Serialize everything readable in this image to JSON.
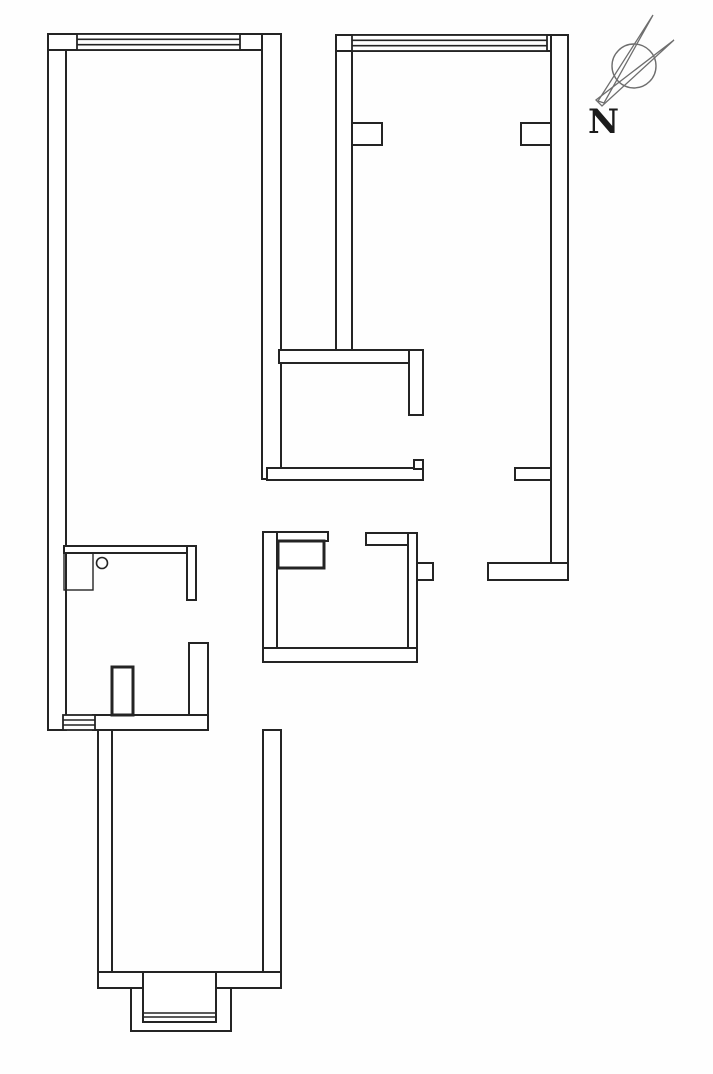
{
  "floorplan": {
    "canvas": {
      "width": 713,
      "height": 1074,
      "line_color": "#242424",
      "wall_fill": "#ffffff",
      "background": "#fefefe"
    },
    "walls": [
      {
        "name": "left-exterior-wall",
        "x": 48,
        "y": 34,
        "w": 18,
        "h": 696
      },
      {
        "name": "top-left-room-top-wall",
        "x": 48,
        "y": 34,
        "w": 233,
        "h": 16
      },
      {
        "name": "left-room-right-wall",
        "x": 262,
        "y": 34,
        "w": 19,
        "h": 445
      },
      {
        "name": "right-room-left-wall",
        "x": 336,
        "y": 35,
        "w": 16,
        "h": 315
      },
      {
        "name": "top-right-room-top-wall",
        "x": 336,
        "y": 35,
        "w": 232,
        "h": 16
      },
      {
        "name": "right-exterior-wall",
        "x": 551,
        "y": 35,
        "w": 17,
        "h": 545
      },
      {
        "name": "right-room-bottom-wall",
        "x": 488,
        "y": 563,
        "w": 80,
        "h": 17
      },
      {
        "name": "right-room-left-pier",
        "x": 352,
        "y": 123,
        "w": 30,
        "h": 22
      },
      {
        "name": "right-room-right-pier",
        "x": 521,
        "y": 123,
        "w": 30,
        "h": 22
      },
      {
        "name": "right-wall-stub",
        "x": 515,
        "y": 468,
        "w": 36,
        "h": 12
      },
      {
        "name": "middle-upper-horizontal-wall",
        "x": 279,
        "y": 350,
        "w": 144,
        "h": 13
      },
      {
        "name": "middle-vertical-wall",
        "x": 409,
        "y": 350,
        "w": 14,
        "h": 65
      },
      {
        "name": "middle-lower-horizontal-wall",
        "x": 267,
        "y": 468,
        "w": 156,
        "h": 12
      },
      {
        "name": "door-jamb-hook",
        "x": 414,
        "y": 460,
        "w": 9,
        "h": 9
      },
      {
        "name": "kitchen-top-wall-left",
        "x": 263,
        "y": 532,
        "w": 65,
        "h": 9
      },
      {
        "name": "kitchen-top-wall-right",
        "x": 366,
        "y": 533,
        "w": 51,
        "h": 12
      },
      {
        "name": "kitchen-left-wall",
        "x": 263,
        "y": 532,
        "w": 14,
        "h": 130
      },
      {
        "name": "kitchen-right-wall",
        "x": 408,
        "y": 533,
        "w": 9,
        "h": 129
      },
      {
        "name": "kitchen-bottom-wall",
        "x": 263,
        "y": 648,
        "w": 154,
        "h": 14
      },
      {
        "name": "kitchen-right-pier",
        "x": 417,
        "y": 563,
        "w": 16,
        "h": 17
      },
      {
        "name": "bathroom-top-wall",
        "x": 64,
        "y": 546,
        "w": 132,
        "h": 7
      },
      {
        "name": "bathroom-right-wall-upper",
        "x": 187,
        "y": 546,
        "w": 9,
        "h": 54
      },
      {
        "name": "bathroom-right-wall-lower",
        "x": 189,
        "y": 643,
        "w": 19,
        "h": 87
      },
      {
        "name": "bathroom-bottom-wall",
        "x": 93,
        "y": 715,
        "w": 115,
        "h": 15
      },
      {
        "name": "balcony-left-wall",
        "x": 98,
        "y": 730,
        "w": 14,
        "h": 258
      },
      {
        "name": "balcony-right-wall",
        "x": 263,
        "y": 730,
        "w": 18,
        "h": 258
      },
      {
        "name": "balcony-bottom-wall-left",
        "x": 98,
        "y": 972,
        "w": 45,
        "h": 16
      },
      {
        "name": "balcony-bottom-wall-right",
        "x": 216,
        "y": 972,
        "w": 65,
        "h": 16
      },
      {
        "name": "bay-window-outer",
        "x": 131,
        "y": 988,
        "w": 100,
        "h": 43
      },
      {
        "name": "bay-window-inner",
        "x": 143,
        "y": 972,
        "w": 73,
        "h": 50
      }
    ],
    "windows": [
      {
        "name": "window-top-left-room",
        "x": 77,
        "y": 34,
        "w": 163,
        "h": 16,
        "inner_lines": 2
      },
      {
        "name": "window-top-right-room",
        "x": 352,
        "y": 35,
        "w": 195,
        "h": 16,
        "inner_lines": 2
      },
      {
        "name": "window-bottom-left",
        "x": 63,
        "y": 715,
        "w": 32,
        "h": 15,
        "inner_lines": 2
      }
    ],
    "fixtures": [
      {
        "name": "kitchen-counter-fixture",
        "x": 278,
        "y": 541,
        "w": 46,
        "h": 27
      },
      {
        "name": "entry-door-leaf",
        "x": 112,
        "y": 667,
        "w": 21,
        "h": 48
      }
    ],
    "furniture": [
      {
        "name": "bathroom-cabinet",
        "x": 64,
        "y": 553,
        "w": 29,
        "h": 37
      }
    ],
    "circles": [
      {
        "name": "bathroom-drain-circle",
        "cx": 102,
        "cy": 563,
        "r": 5.5
      }
    ],
    "lines": [
      {
        "name": "bay-window-glazing-line",
        "x1": 143,
        "y1": 1013,
        "x2": 216,
        "y2": 1013
      },
      {
        "name": "bay-window-glazing-line",
        "x1": 143,
        "y1": 1017,
        "x2": 216,
        "y2": 1017
      }
    ],
    "compass": {
      "label": "N",
      "color": "#6e6e6e",
      "label_color": "#1b1b1b",
      "cx": 634,
      "cy": 66,
      "r": 22,
      "needles": [
        [
          598,
          101,
          604,
          103,
          653,
          15
        ],
        [
          596,
          100,
          602,
          106,
          674,
          40
        ]
      ],
      "label_x": 588,
      "label_y": 133,
      "label_size": 34
    }
  }
}
